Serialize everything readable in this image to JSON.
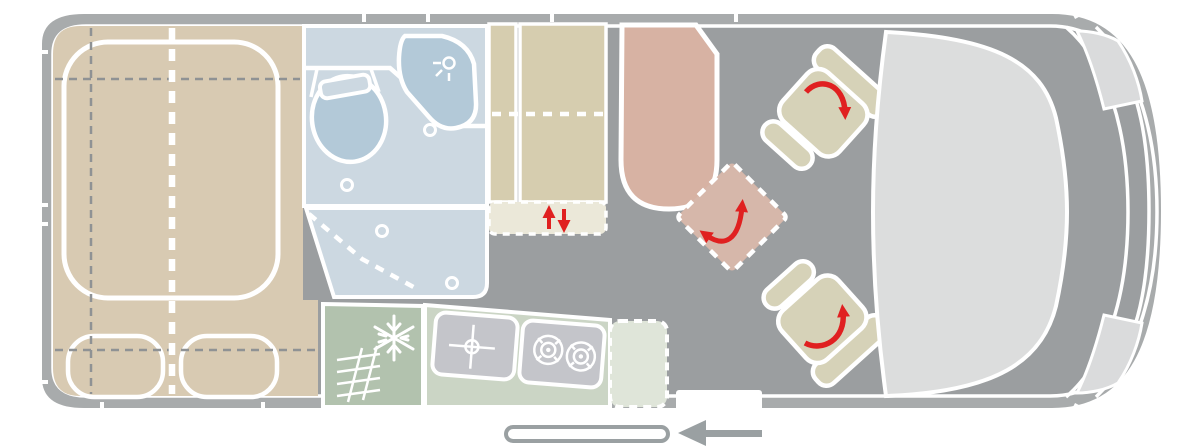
{
  "diagram": {
    "type": "campervan-floorplan-top-view",
    "regions": [
      "rear-double-bed",
      "bathroom",
      "wardrobe",
      "kitchen",
      "dinette-table",
      "swivel-seats",
      "cab-dashboard",
      "entry-door"
    ]
  },
  "icons": {
    "snowflake-icon": "fridge-freezer",
    "vent-icon": "heater-grille",
    "shower-head-icon": "shower",
    "drain-crosshair-icon": "sink",
    "burner-icon": "two-ring gas hob",
    "rotation-arrow-icon": "swivel seat / swivel table direction",
    "up-down-arrow-icon": "lift / drop-down element",
    "door-arrow-icon": "sliding door opening direction"
  },
  "colors": {
    "line": "#ffffff",
    "wall": "#a8abac",
    "floor": "#9b9ea0",
    "bed": "#d8cab2",
    "bath": "#ccd8e1",
    "fixture": "#b3c9d8",
    "ward": "#d6cdaf",
    "cream": "#ebe8d9",
    "table": "#d7b2a3",
    "table2": "#d6b7aa",
    "seat": "#d6d2b8",
    "kitchen_dark": "#b2c2ae",
    "kitchen_light": "#cbd5c5",
    "kitchen_ext": "#dfe5d9",
    "appliance": "#c4c5ca",
    "dashboard": "#dcdddd",
    "headlight": "#dadbdc",
    "red": "#e02020",
    "dash_grey": "#8f9294",
    "rail": "#9aa0a2"
  }
}
